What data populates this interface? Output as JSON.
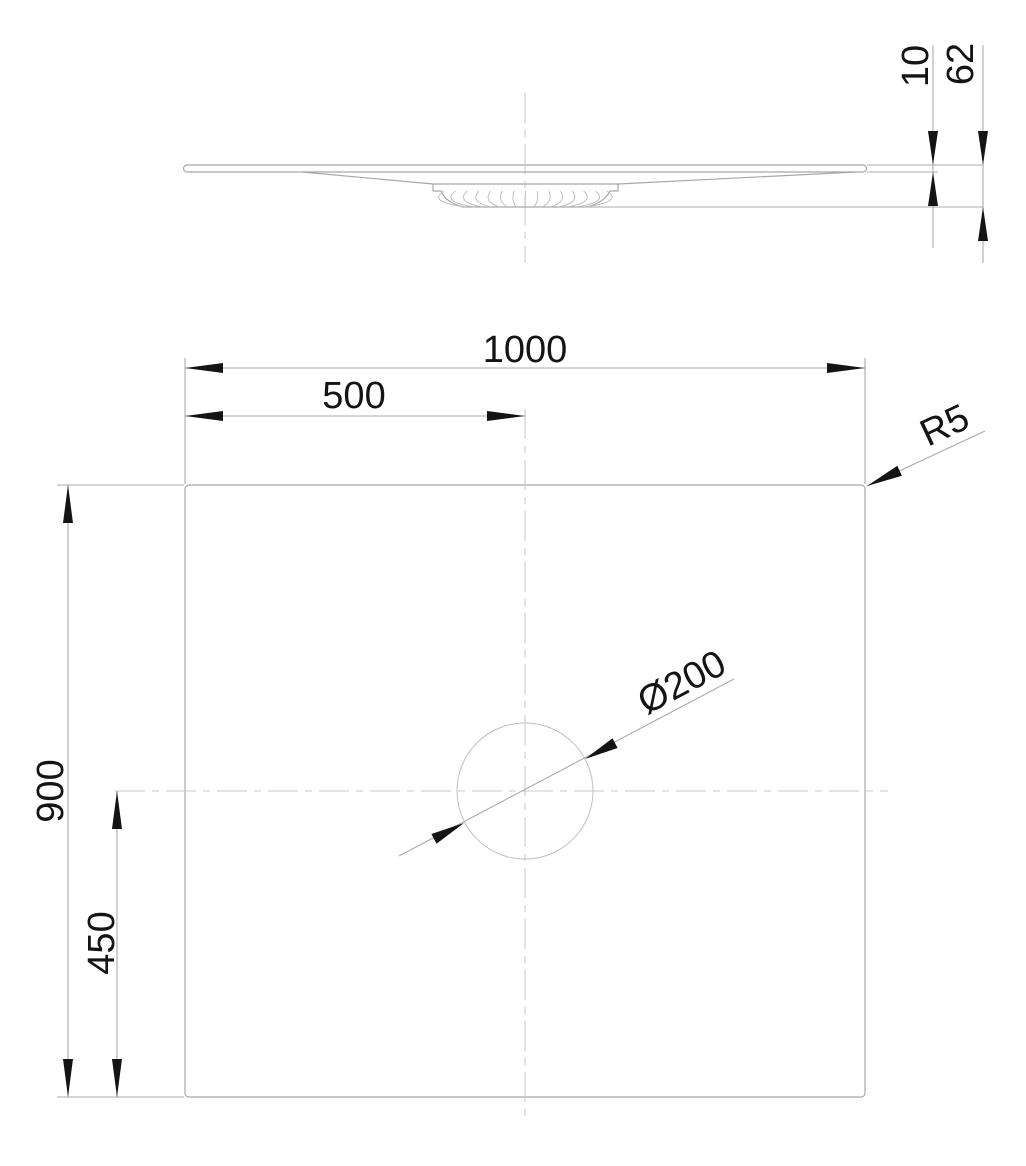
{
  "drawing": {
    "colors": {
      "background": "#ffffff",
      "geometry": "#a8a8a8",
      "geometry_light": "#bfbfbf",
      "centerline": "#c9c9c9",
      "dimension_line": "#ababab",
      "dimension_text": "#141414",
      "arrow": "#141414"
    },
    "dimensions": {
      "plan": {
        "width": "1000",
        "width_to_center": "500",
        "depth": "900",
        "depth_to_center": "450",
        "corner_radius": "R5",
        "drain_diameter": "Ø200"
      },
      "profile": {
        "rim_thickness": "10",
        "overall_height": "62"
      }
    }
  }
}
